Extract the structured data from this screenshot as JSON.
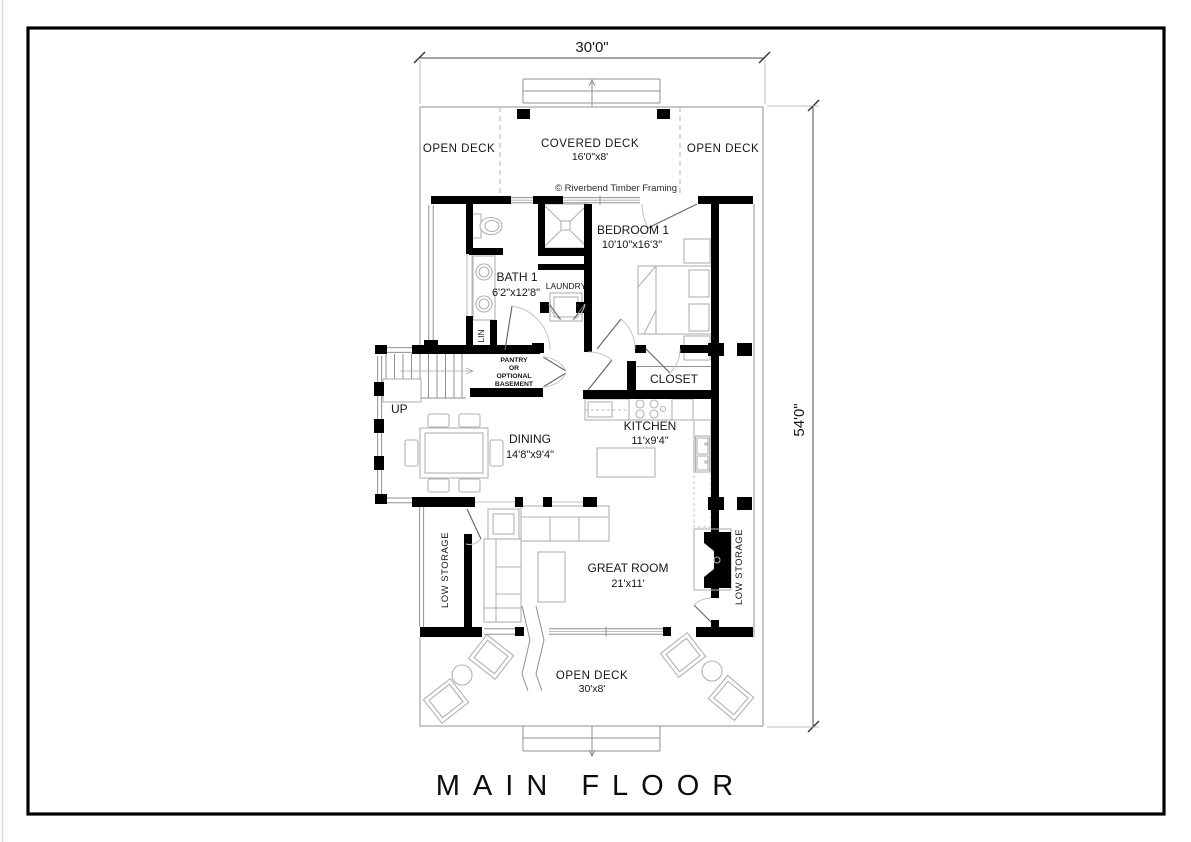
{
  "page": {
    "title": "MAIN FLOOR",
    "copyright": "© Riverbend Timber Framing"
  },
  "dimensions": {
    "overall_width": "30'0\"",
    "overall_depth": "54'0\""
  },
  "stairs": {
    "direction_label": "UP"
  },
  "rooms": {
    "open_deck_top_left": {
      "name": "OPEN DECK"
    },
    "covered_deck": {
      "name": "COVERED DECK",
      "size": "16'0\"x8'"
    },
    "open_deck_top_right": {
      "name": "OPEN DECK"
    },
    "bath1": {
      "name": "BATH 1",
      "size": "6'2\"x12'8\""
    },
    "laundry": {
      "name": "LAUNDRY"
    },
    "linen": {
      "name": "LIN"
    },
    "bedroom1": {
      "name": "BEDROOM 1",
      "size": "10'10\"x16'3\""
    },
    "pantry": {
      "line1": "PANTRY",
      "line2": "OR",
      "line3": "OPTIONAL",
      "line4": "BASEMENT"
    },
    "closet": {
      "name": "CLOSET"
    },
    "kitchen": {
      "name": "KITCHEN",
      "size": "11'x9'4\""
    },
    "dining": {
      "name": "DINING",
      "size": "14'8\"x9'4\""
    },
    "great_room": {
      "name": "GREAT ROOM",
      "size": "21'x11'"
    },
    "low_storage_left": {
      "name": "LOW STORAGE"
    },
    "low_storage_right": {
      "name": "LOW STORAGE"
    },
    "open_deck_bottom": {
      "name": "OPEN DECK",
      "size": "30'x8'"
    }
  },
  "colors": {
    "wall": "#000000",
    "thin_line": "#909090",
    "furniture": "#b2b2b2",
    "text": "#161616"
  }
}
